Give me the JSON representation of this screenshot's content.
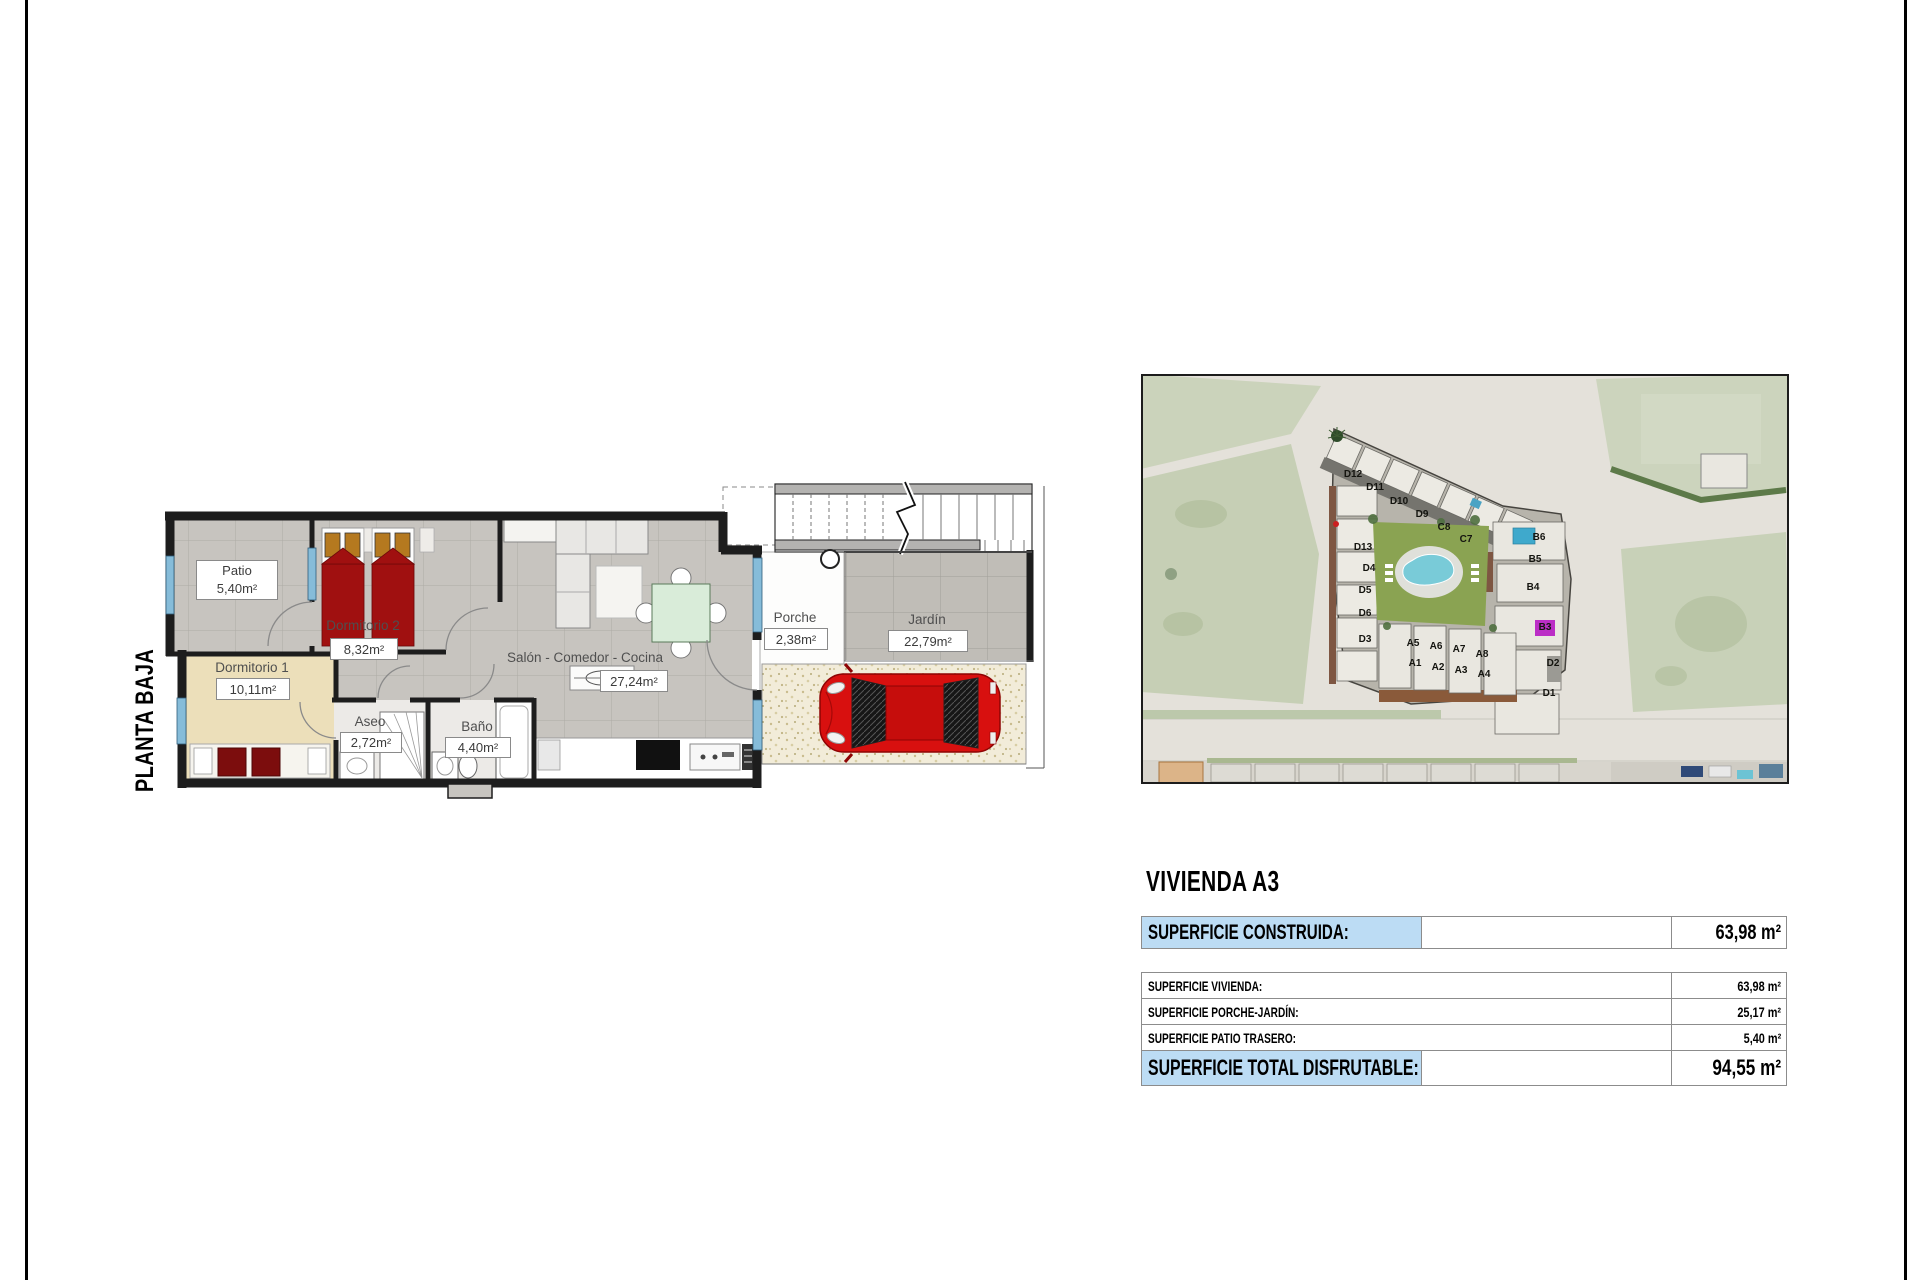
{
  "sheet": {
    "floor_label": "PLANTA BAJA"
  },
  "floor_plan": {
    "rooms": [
      {
        "name": "Patio",
        "area": "5,40m²"
      },
      {
        "name": "Dormitorio 2",
        "area": "8,32m²"
      },
      {
        "name": "Dormitorio 1",
        "area": "10,11m²"
      },
      {
        "name": "Aseo",
        "area": "2,72m²"
      },
      {
        "name": "Baño",
        "area": "4,40m²"
      },
      {
        "name": "Salón - Comedor - Cocina",
        "area": "27,24m²"
      },
      {
        "name": "Porche",
        "area": "2,38m²"
      },
      {
        "name": "Jardín",
        "area": "22,79m²"
      }
    ]
  },
  "aerial": {
    "units": [
      "D12",
      "D11",
      "D10",
      "D9",
      "C8",
      "C7",
      "D13",
      "D4",
      "D5",
      "D6",
      "D3",
      "A5",
      "A6",
      "A7",
      "A8",
      "A1",
      "A2",
      "A3",
      "A4",
      "B6",
      "B5",
      "B4",
      "B3",
      "D2",
      "D1"
    ]
  },
  "summary": {
    "title": "VIVIENDA A3",
    "construida": {
      "label": "SUPERFICIE CONSTRUIDA:",
      "value": "63,98 m²"
    },
    "vivienda": {
      "label": "SUPERFICIE VIVIENDA:",
      "value": "63,98 m²"
    },
    "porche_jardin": {
      "label": "SUPERFICIE PORCHE-JARDÍN:",
      "value": "25,17 m²"
    },
    "patio_trasero": {
      "label": "SUPERFICIE PATIO TRASERO:",
      "value": "5,40 m²"
    },
    "total": {
      "label": "SUPERFICIE TOTAL DISFRUTABLE:",
      "value": "94,55 m²"
    }
  },
  "colors": {
    "highlight_blue": "#bcdcf4",
    "bed_red": "#a01010",
    "car_red": "#d8100f",
    "pool_cyan": "#79cbd8",
    "table_border": "#8c8c8c"
  }
}
